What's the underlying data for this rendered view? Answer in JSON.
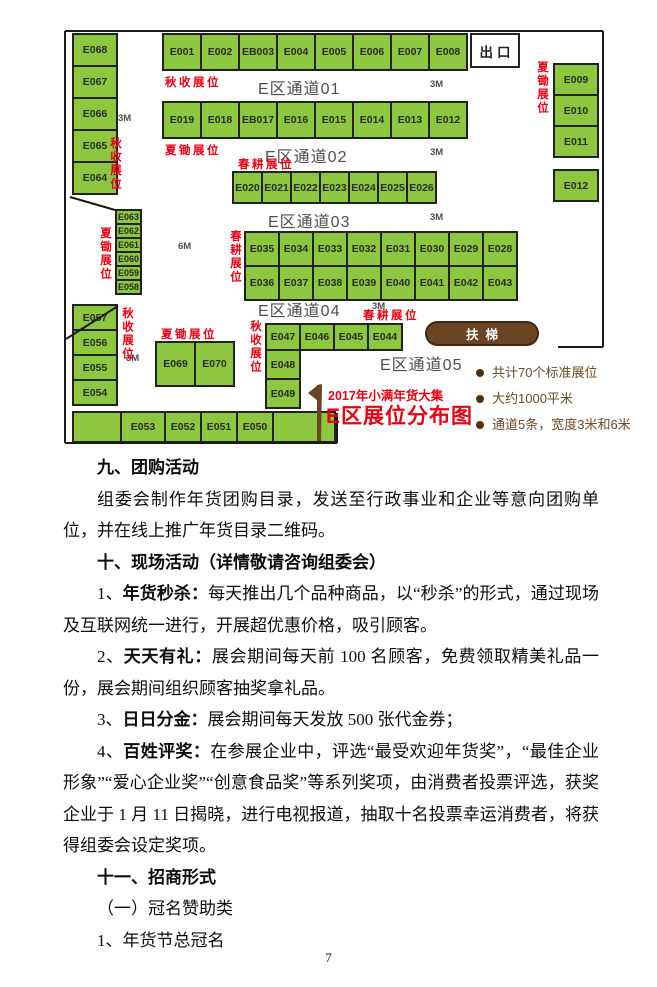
{
  "floorplan": {
    "exit_label": "出口",
    "escalator_label": "扶梯",
    "flag_title": {
      "line1": "2017年小满年货大集",
      "line2": "E区展位分布图"
    },
    "notes": [
      "共计70个标准展位",
      "大约1000平米",
      "通道5条，宽度3米和6米"
    ],
    "aisles": [
      {
        "label": "E区通道01",
        "x": 200,
        "y": 50,
        "m": "3M",
        "mx": 372,
        "my": 54
      },
      {
        "label": "E区通道02",
        "x": 207,
        "y": 118,
        "m": "3M",
        "mx": 372,
        "my": 122
      },
      {
        "label": "E区通道03",
        "x": 210,
        "y": 183,
        "m": "3M",
        "mx": 372,
        "my": 187
      },
      {
        "label": "E区通道04",
        "x": 200,
        "y": 272,
        "m": "3M",
        "mx": 314,
        "my": 276
      },
      {
        "label": "E区通道05",
        "x": 322,
        "y": 326,
        "m": null,
        "mx": 0,
        "my": 0
      }
    ],
    "size_labels": [
      {
        "t": "3M",
        "x": 60,
        "y": 88
      },
      {
        "t": "6M",
        "x": 120,
        "y": 216
      },
      {
        "t": "3M",
        "x": 68,
        "y": 328
      }
    ],
    "red_labels": [
      {
        "t": "秋收展位",
        "x": 107,
        "y": 49,
        "d": "h"
      },
      {
        "t": "夏锄展位",
        "x": 107,
        "y": 117,
        "d": "h"
      },
      {
        "t": "春耕展位",
        "x": 180,
        "y": 131,
        "d": "h"
      },
      {
        "t": "夏锄展位",
        "x": 477,
        "y": 36,
        "d": "v"
      },
      {
        "t": "秋收展位",
        "x": 50,
        "y": 112,
        "d": "v"
      },
      {
        "t": "夏锄展位",
        "x": 40,
        "y": 202,
        "d": "v"
      },
      {
        "t": "春耕展位",
        "x": 170,
        "y": 205,
        "d": "v"
      },
      {
        "t": "秋收展位",
        "x": 62,
        "y": 282,
        "d": "v"
      },
      {
        "t": "夏锄展位",
        "x": 103,
        "y": 301,
        "d": "h"
      },
      {
        "t": "秋收展位",
        "x": 190,
        "y": 295,
        "d": "v"
      },
      {
        "t": "春耕展位",
        "x": 305,
        "y": 282,
        "d": "h"
      }
    ],
    "booth_groups": [
      {
        "id": "left-col",
        "x": 14,
        "y": 8,
        "dir": "v",
        "cw": 46,
        "ch": 34,
        "booths": [
          "E068",
          "E067",
          "E066",
          "E065",
          "E064"
        ]
      },
      {
        "id": "top-row",
        "x": 104,
        "y": 8,
        "dir": "h",
        "cw": 40,
        "ch": 38,
        "booths": [
          "E001",
          "E002",
          "EB003",
          "E004",
          "E005",
          "E006",
          "E007",
          "E008"
        ]
      },
      {
        "id": "row2",
        "x": 104,
        "y": 76,
        "dir": "h",
        "cw": 40,
        "ch": 38,
        "booths": [
          "E019",
          "E018",
          "EB017",
          "E016",
          "E015",
          "E014",
          "E013",
          "E012"
        ]
      },
      {
        "id": "right-col",
        "x": 495,
        "y": 38,
        "dir": "v",
        "cw": 46,
        "ch": 33,
        "booths": [
          "E009",
          "E010",
          "E011"
        ]
      },
      {
        "id": "right-single",
        "x": 495,
        "y": 144,
        "dir": "v",
        "cw": 46,
        "ch": 33,
        "booths": [
          "E012"
        ]
      },
      {
        "id": "row3",
        "x": 174,
        "y": 146,
        "dir": "h",
        "cw": 31,
        "ch": 33,
        "booths": [
          "E020",
          "E021",
          "E022",
          "E023",
          "E024",
          "E025",
          "E026"
        ]
      },
      {
        "id": "row4",
        "x": 186,
        "y": 206,
        "dir": "h",
        "cw": 36,
        "ch": 36,
        "booths": [
          "E035",
          "E034",
          "E033",
          "E032",
          "E031",
          "E030",
          "E029",
          "E028"
        ]
      },
      {
        "id": "row5",
        "x": 186,
        "y": 240,
        "dir": "h",
        "cw": 36,
        "ch": 36,
        "booths": [
          "E036",
          "E037",
          "E038",
          "E039",
          "E040",
          "E041",
          "E042",
          "E043"
        ]
      },
      {
        "id": "mini-col",
        "x": 57,
        "y": 184,
        "dir": "v",
        "cw": 27,
        "ch": 16,
        "fs": 9,
        "booths": [
          "E063",
          "E062",
          "E061",
          "E060",
          "E059",
          "E058"
        ]
      },
      {
        "id": "left-col2",
        "x": 14,
        "y": 279,
        "dir": "v",
        "cw": 46,
        "ch": 27,
        "booths": [
          "E057",
          "E056",
          "E055",
          "E054"
        ]
      },
      {
        "id": "island",
        "x": 97,
        "y": 316,
        "dir": "h",
        "cw": 41,
        "ch": 46,
        "booths": [
          "E069",
          "E070"
        ]
      },
      {
        "id": "row-e44",
        "x": 207,
        "y": 298,
        "dir": "h",
        "cw": 36,
        "ch": 28,
        "booths": [
          "E047",
          "E046",
          "E045",
          "E044"
        ]
      },
      {
        "id": "col-e48",
        "x": 207,
        "y": 324,
        "dir": "v",
        "cw": 36,
        "ch": 31,
        "booths": [
          "E048",
          "E049"
        ]
      },
      {
        "id": "bottom-row",
        "x": 14,
        "y": 386,
        "dir": "h",
        "ch": 32,
        "cws": [
          50,
          46,
          38,
          38,
          38,
          64
        ],
        "booths": [
          "",
          "E053",
          "E052",
          "E051",
          "E050",
          ""
        ]
      }
    ]
  },
  "content": {
    "s9_heading": "九、团购活动",
    "s9_para": "组委会制作年货团购目录，发送至行政事业和企业等意向团购单位，并在线上推广年货目录二维码。",
    "s10_heading": "十、现场活动（详情敬请咨询组委会）",
    "items": [
      {
        "num": "1、",
        "label": "年货秒杀：",
        "text": "每天推出几个品种商品，以“秒杀”的形式，通过现场及互联网统一进行，开展超优惠价格，吸引顾客。"
      },
      {
        "num": "2、",
        "label": "天天有礼：",
        "text": "展会期间每天前 100 名顾客，免费领取精美礼品一份，展会期间组织顾客抽奖拿礼品。"
      },
      {
        "num": "3、",
        "label": "日日分金：",
        "text": "展会期间每天发放 500 张代金券；"
      },
      {
        "num": "4、",
        "label": "百姓评奖：",
        "text": "在参展企业中，评选“最受欢迎年货奖”，“最佳企业形象”“爱心企业奖”“创意食品奖”等系列奖项，由消费者投票评选，获奖企业于 1 月 11 日揭晓，进行电视报道，抽取十名投票幸运消费者，将获得组委会设定奖项。"
      }
    ],
    "s11_heading": "十一、招商形式",
    "s11_line1": "（一）冠名赞助类",
    "s11_line2": "1、年货节总冠名"
  },
  "page": {
    "number": "7"
  }
}
